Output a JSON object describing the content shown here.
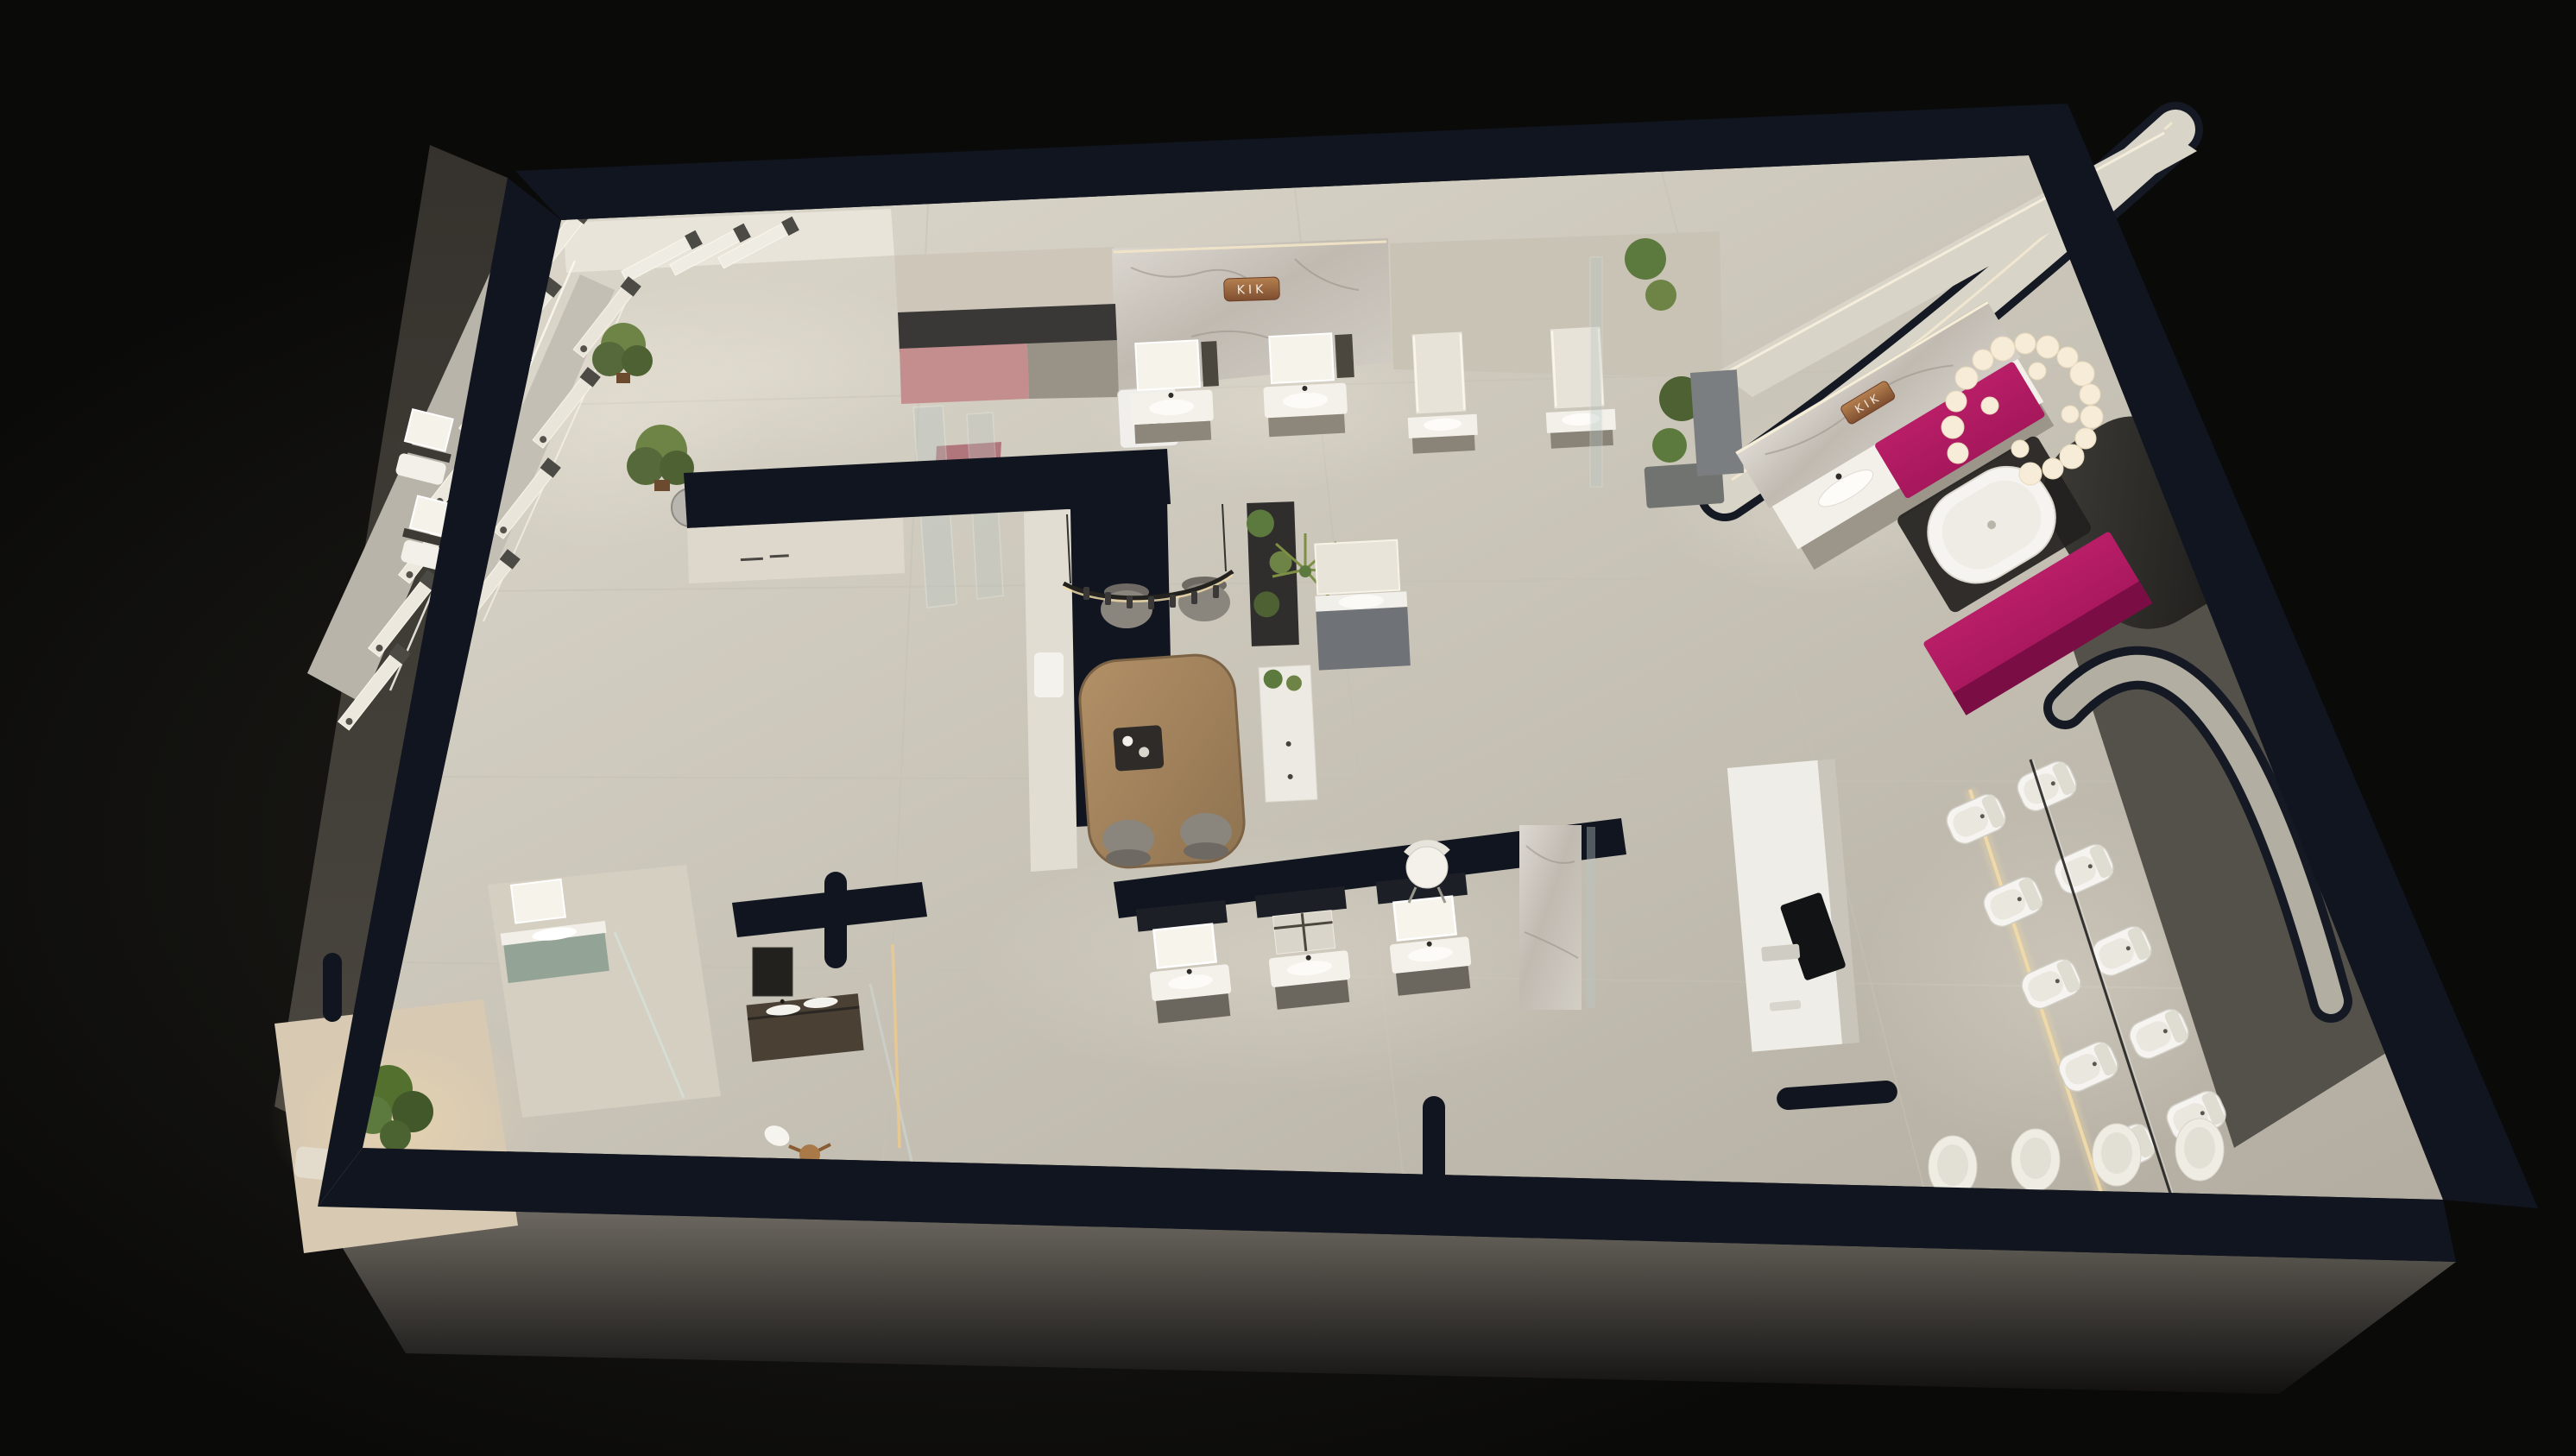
{
  "brand": "KIK",
  "signs": {
    "north_wall": "KIK",
    "east_wall": "KIK"
  },
  "palette": {
    "background": "#0a0a09",
    "background_glow": "#22201b",
    "floor_light": "#ded9cd",
    "floor_dark": "#b3ada1",
    "wall_cut": "#10151f",
    "wall_face_light": "#d9d4c8",
    "wall_face_beige": "#c9c3b6",
    "facade_gray": "#6e6a62",
    "marble": "#d3cec6",
    "copper": "#9c6647",
    "accent_magenta": "#a6175c",
    "accent_magenta_dark": "#7a0e44",
    "accent_pink": "#c48e8e",
    "wood": "#a98a63",
    "plant_green": "#637d3f",
    "sage": "#93a396",
    "led_warm": "#eed9a8",
    "white_fixture": "#f5f4f0",
    "gray_cabinet": "#6f7276",
    "screen_dark": "#121315"
  },
  "areas": [
    {
      "name": "shower-display-gallery",
      "items": [
        "rain-shower-panels",
        "hand-showers",
        "led-strip-outlines",
        "potted-palms",
        "pendant-dome-lamp"
      ]
    },
    {
      "name": "laundry-kitchenette",
      "items": [
        "dusty-pink-counter",
        "charcoal-backsplash",
        "washing-machine",
        "glass-shower-screen"
      ]
    },
    {
      "name": "north-vanity-row",
      "items": [
        "marble-feature-wall",
        "copper-brand-sign",
        "led-mirror-vanities",
        "tall-mirror-vanities",
        "display-niche"
      ]
    },
    {
      "name": "consultation-area",
      "items": [
        "wood-table",
        "four-gray-chairs",
        "curved-pendant-light",
        "decor-tray",
        "plant-shelf-divider",
        "palm-plant"
      ]
    },
    {
      "name": "bathtub-suite",
      "items": [
        "freestanding-white-bathtub",
        "magenta-cabinets",
        "bubble-cluster-chandelier",
        "marble-wall-with-brand-sign",
        "double-basin-vanity",
        "dark-arched-alcove",
        "curved-lit-wall"
      ]
    },
    {
      "name": "toilet-gallery",
      "items": [
        "ten-display-toilets",
        "center-glass-screen",
        "led-platform-glow",
        "reception-desk",
        "monitor",
        "white-chair",
        "four-wall-hung-toilets-at-front-wall"
      ]
    },
    {
      "name": "south-vanity-row",
      "items": [
        "three-vanity-units",
        "partition-wall",
        "marble-pillar"
      ]
    },
    {
      "name": "west-bathroom-mockups",
      "items": [
        "sage-green-vanity",
        "glass-shower-screen",
        "dark-wood-vanity",
        "wooden-stool",
        "white-towel",
        "indoor-tree",
        "corridor-mirror-vanities"
      ]
    }
  ],
  "counts": {
    "display_toilets": 10,
    "wall_hung_toilets": 4,
    "dining_chairs": 4,
    "chandelier_bulbs": 20,
    "shower_display_panels": 14,
    "vanity_units_visible": 15,
    "brand_signs": 2,
    "washing_machines": 1,
    "bathtubs": 1,
    "reception_desks": 1,
    "monitors": 1,
    "dining_tables": 1,
    "potted_plants": 8
  }
}
